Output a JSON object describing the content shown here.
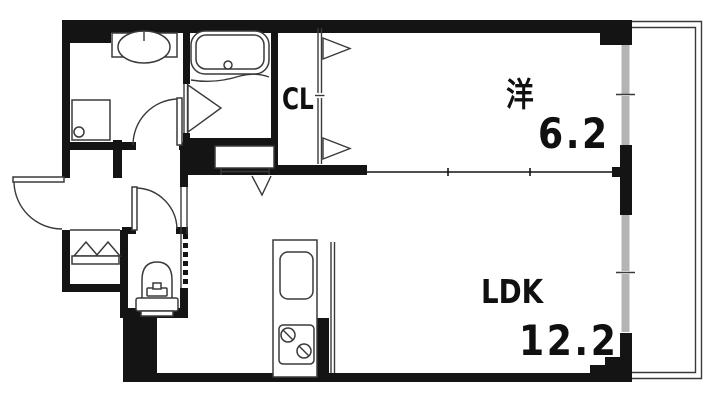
{
  "colors": {
    "wall": "#141414",
    "line": "#3a3a3a",
    "glazing": "#b4b4b4",
    "bg": "#ffffff"
  },
  "rooms": {
    "western_room": {
      "label": "洋",
      "area": "6.2"
    },
    "ldk": {
      "label": "LDK",
      "area": "12.2"
    },
    "closet": {
      "label": "CL"
    }
  },
  "fixtures": [
    "bathtub",
    "wash-basin",
    "washing-machine-pan",
    "toilet",
    "shoe-cabinet",
    "kitchen-counter",
    "kitchen-sink",
    "gas-stove",
    "entrance-door",
    "washroom-door",
    "toilet-door",
    "bathroom-folding-door",
    "closet-folding-door",
    "hall-ldk-door",
    "sliding-partition",
    "sliding-windows",
    "balcony"
  ]
}
